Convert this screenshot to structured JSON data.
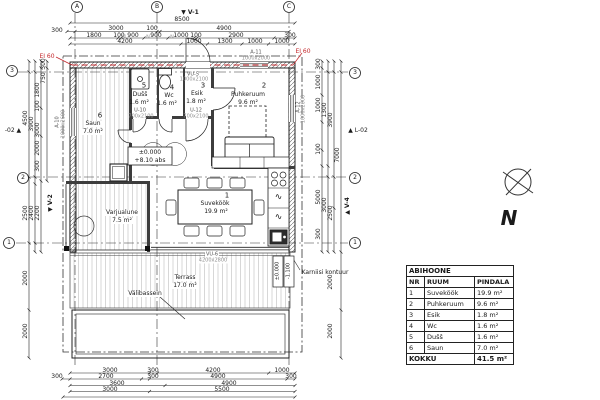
{
  "markers": {
    "v1": "▼ V-1",
    "v2": "▼ V-2",
    "v4": "▲ V-4",
    "cut_left": "-02 ▲",
    "cut_right": "▲ L-02"
  },
  "north": {
    "letter": "N"
  },
  "fire": {
    "label": "EI 60"
  },
  "grid": {
    "cols": [
      "A",
      "B",
      "C"
    ],
    "rows": [
      "3",
      "2",
      "1"
    ]
  },
  "rooms": {
    "suvekook": {
      "nr": "1",
      "name": "Suveköök",
      "area": "19.9 m²"
    },
    "puhkeruum": {
      "nr": "2",
      "name": "Puhkeruum",
      "area": "9.6 m²"
    },
    "esik": {
      "nr": "3",
      "name": "Esik",
      "area": "1.8 m²"
    },
    "wc": {
      "nr": "4",
      "name": "Wc",
      "area": "1.6 m²"
    },
    "dushsh": {
      "nr": "5",
      "name": "Dušš",
      "area": "1.6 m²"
    },
    "saun": {
      "nr": "6",
      "name": "Saun",
      "area": "7.0 m²"
    },
    "varjualune": {
      "name": "Varjualune",
      "area": "7.5 m²"
    },
    "terrass": {
      "name": "Terrass",
      "area": "17.0 m²"
    },
    "valibassein": {
      "name": "Välibassein"
    }
  },
  "openings": {
    "vu5": {
      "code": "VU-5",
      "size": "1000x2100"
    },
    "vu6": {
      "code": "VU-6",
      "size": "4200x2800"
    },
    "u10": {
      "code": "U-10",
      "size": "700x2100"
    },
    "u12": {
      "code": "U-12",
      "size": "700x2100"
    },
    "a10": {
      "code": "A-10",
      "size": "1000x2600"
    },
    "a11": {
      "code": "A-11",
      "size": "1000x2000"
    },
    "a12": {
      "code": "A-12",
      "size": "1000x2600"
    }
  },
  "elev": {
    "main": "±0.000",
    "abs": "+8.10 abs",
    "terrace": "±0.000",
    "pool": "-1.100"
  },
  "notes": {
    "cornice": "Karniisi kontuur"
  },
  "icons": {
    "wave": "∿"
  },
  "dims": {
    "n_mark": "N",
    "top1": [
      "8500"
    ],
    "top2": [
      "300",
      "3000",
      "100",
      "4900"
    ],
    "top3": [
      "1800",
      "100",
      "900",
      "900",
      "1000",
      "100",
      "2900",
      "300"
    ],
    "top4": [
      "4200",
      "1000",
      "1300",
      "1000",
      "1000"
    ],
    "bottom1": [
      "3000",
      "300",
      "4200",
      "1000"
    ],
    "bottom2": [
      "300",
      "2700",
      "300",
      "4900",
      "300"
    ],
    "bottom3": [
      "3600",
      "4900"
    ],
    "bottom4": [
      "3000",
      "5500"
    ],
    "left": [
      "300",
      "750",
      "1800",
      "100",
      "4500",
      "3900",
      "3000",
      "2000",
      "300",
      "2500",
      "2400",
      "2200",
      "2000",
      "2000"
    ],
    "right": [
      "300",
      "1000",
      "1000",
      "1300",
      "3900",
      "100",
      "7000",
      "5000",
      "3000",
      "2500",
      "300",
      "2000",
      "2000"
    ]
  },
  "table": {
    "title": "ABIHOONE",
    "headers": [
      "NR",
      "RUUM",
      "PINDALA"
    ],
    "rows": [
      [
        "1",
        "Suveköök",
        "19.9 m²"
      ],
      [
        "2",
        "Puhkeruum",
        "9.6 m²"
      ],
      [
        "3",
        "Esik",
        "1.8 m²"
      ],
      [
        "4",
        "Wc",
        "1.6 m²"
      ],
      [
        "5",
        "Dušš",
        "1.6 m²"
      ],
      [
        "6",
        "Saun",
        "7.0 m²"
      ]
    ],
    "total_label": "KOKKU",
    "total_value": "41.5 m²"
  },
  "colors": {
    "fire_red": "#c3272b",
    "line": "#1a1a1a",
    "secondary": "#8f8f8f"
  }
}
